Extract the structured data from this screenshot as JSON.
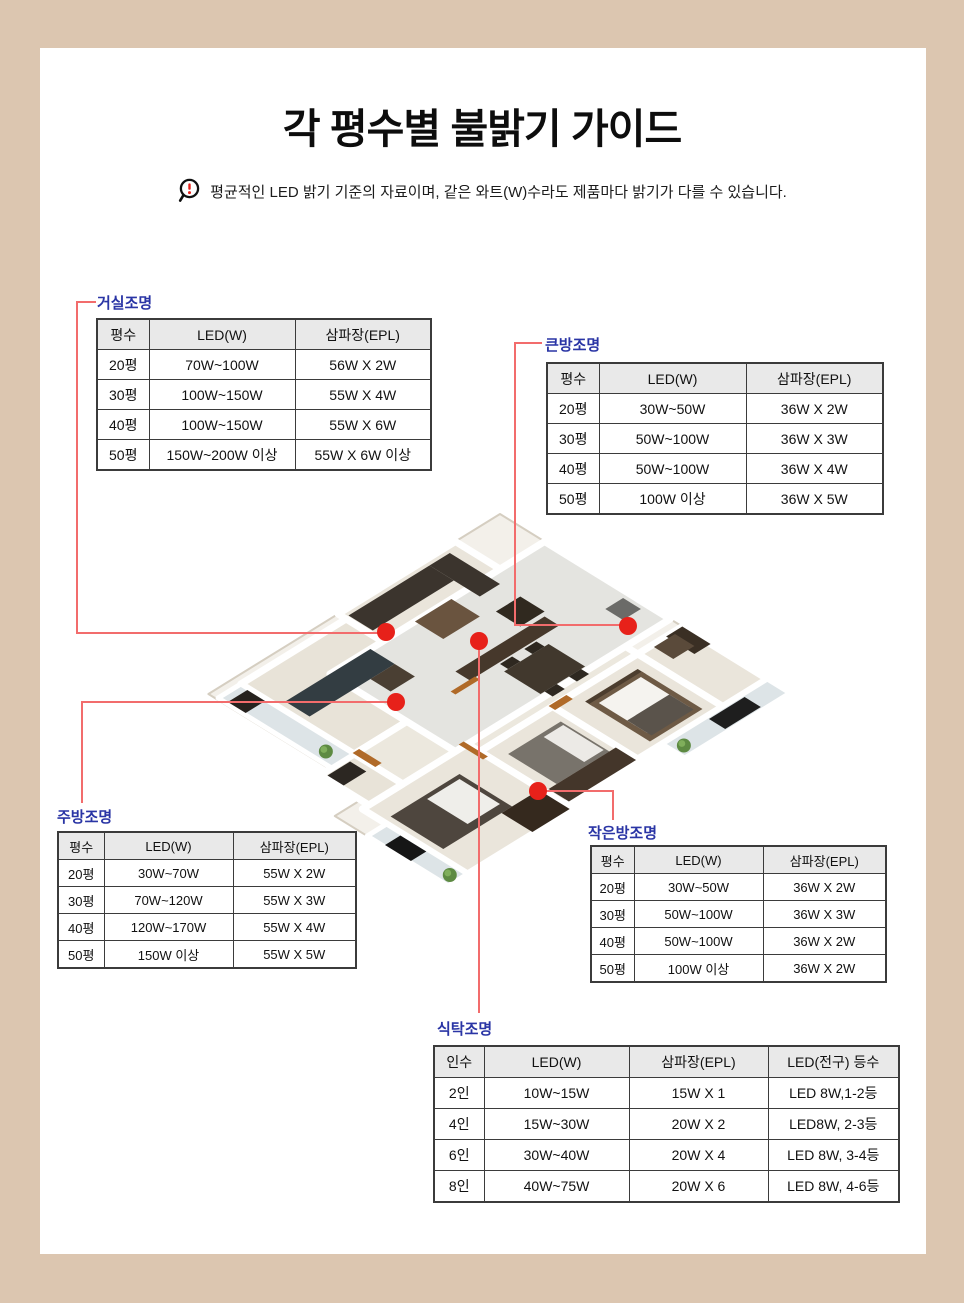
{
  "header": {
    "title": "각 평수별 불밝기 가이드",
    "notice_icon": "magnifier-exclamation-icon",
    "notice": "평균적인 LED 밝기 기준의 자료이며, 같은 와트(W)수라도 제품마다 밝기가 다를 수 있습니다."
  },
  "colors": {
    "frame_tan": "#dcc6b0",
    "label_navy": "#2a35a5",
    "callout_line_red": "#f26c6c",
    "marker_dot_red": "#e7211a",
    "table_header_gray": "#e9e9e9",
    "table_border": "#3b3b3b"
  },
  "tables": {
    "living": {
      "label": "거실조명",
      "headers": [
        "평수",
        "LED(W)",
        "삼파장(EPL)"
      ],
      "rows": [
        [
          "20평",
          "70W~100W",
          "56W X 2W"
        ],
        [
          "30평",
          "100W~150W",
          "55W X 4W"
        ],
        [
          "40평",
          "100W~150W",
          "55W X 6W"
        ],
        [
          "50평",
          "150W~200W 이상",
          "55W X 6W 이상"
        ]
      ]
    },
    "big_room": {
      "label": "큰방조명",
      "headers": [
        "평수",
        "LED(W)",
        "삼파장(EPL)"
      ],
      "rows": [
        [
          "20평",
          "30W~50W",
          "36W X 2W"
        ],
        [
          "30평",
          "50W~100W",
          "36W X 3W"
        ],
        [
          "40평",
          "50W~100W",
          "36W X 4W"
        ],
        [
          "50평",
          "100W 이상",
          "36W X 5W"
        ]
      ]
    },
    "kitchen": {
      "label": "주방조명",
      "headers": [
        "평수",
        "LED(W)",
        "삼파장(EPL)"
      ],
      "rows": [
        [
          "20평",
          "30W~70W",
          "55W X 2W"
        ],
        [
          "30평",
          "70W~120W",
          "55W X 3W"
        ],
        [
          "40평",
          "120W~170W",
          "55W X 4W"
        ],
        [
          "50평",
          "150W 이상",
          "55W X 5W"
        ]
      ]
    },
    "small_room": {
      "label": "작은방조명",
      "headers": [
        "평수",
        "LED(W)",
        "삼파장(EPL)"
      ],
      "rows": [
        [
          "20평",
          "30W~50W",
          "36W X 2W"
        ],
        [
          "30평",
          "50W~100W",
          "36W X 3W"
        ],
        [
          "40평",
          "50W~100W",
          "36W X 2W"
        ],
        [
          "50평",
          "100W 이상",
          "36W X 2W"
        ]
      ]
    },
    "dining": {
      "label": "식탁조명",
      "headers": [
        "인수",
        "LED(W)",
        "삼파장(EPL)",
        "LED(전구) 등수"
      ],
      "rows": [
        [
          "2인",
          "10W~15W",
          "15W X 1",
          "LED 8W,1-2등"
        ],
        [
          "4인",
          "15W~30W",
          "20W X 2",
          "LED8W, 2-3등"
        ],
        [
          "6인",
          "30W~40W",
          "20W X 4",
          "LED 8W, 3-4등"
        ],
        [
          "8인",
          "40W~75W",
          "20W X 6",
          "LED 8W, 4-6등"
        ]
      ]
    }
  },
  "floorplan": {
    "description": "3D isometric apartment floor plan with red marker dots on living room, dining table, big bedroom, kitchen and small bedroom"
  }
}
